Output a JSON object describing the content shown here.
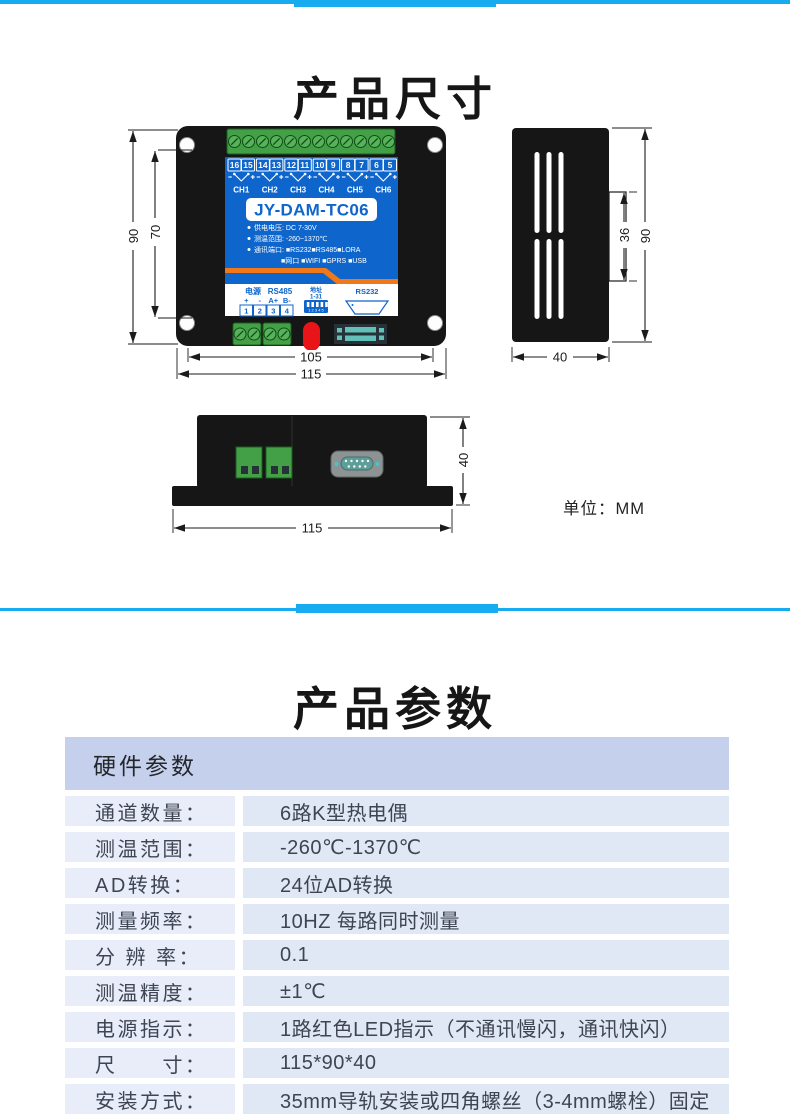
{
  "accent_color": "#17abf0",
  "sections": {
    "dimensions": {
      "title": "产品尺寸",
      "unit_note": "单位：MM"
    },
    "parameters": {
      "title": "产品参数"
    }
  },
  "front": {
    "model": "JY-DAM-TC06",
    "terminals": [
      "16",
      "15",
      "14",
      "13",
      "12",
      "11",
      "10",
      "9",
      "8",
      "7",
      "6",
      "5"
    ],
    "channels": [
      "CH1",
      "CH2",
      "CH3",
      "CH4",
      "CH5",
      "CH6"
    ],
    "specs": [
      "供电电压: DC 7-30V",
      "测温范围: -260~1370℃",
      "通讯端口: ■RS232■RS485■LORA",
      "■网口 ■WIFI ■GPRS ■USB"
    ],
    "power_label": "电源",
    "rs485_label": "RS485",
    "pins": [
      "+",
      "-",
      "A+",
      "B-"
    ],
    "pin_numbers": [
      "1",
      "2",
      "3",
      "4"
    ],
    "addr_label": "地址",
    "addr_range": "1-31",
    "dip_numbers": "1 2 3 4 5",
    "rs232_label": "RS232",
    "dim_outer_height": "90",
    "dim_inner_height": "70",
    "dim_inner_width": "105",
    "dim_outer_width": "115"
  },
  "side": {
    "dim_tab": "36",
    "dim_height": "90",
    "dim_depth": "40"
  },
  "bottom": {
    "dim_depth": "40",
    "dim_width": "115"
  },
  "table": {
    "header": "硬件参数",
    "rows": [
      {
        "label": "通道数量：",
        "value": "6路K型热电偶"
      },
      {
        "label": "测温范围：",
        "value": "-260℃-1370℃"
      },
      {
        "label": "AD转换：",
        "value": "24位AD转换"
      },
      {
        "label": "测量频率：",
        "value": "10HZ 每路同时测量"
      },
      {
        "label": "分 辨 率：",
        "value": "0.1"
      },
      {
        "label": "测温精度：",
        "value": "±1℃"
      },
      {
        "label": "电源指示：",
        "value": "1路红色LED指示（不通讯慢闪，通讯快闪）"
      },
      {
        "label": "尺　　寸：",
        "value": "115*90*40"
      },
      {
        "label": "安装方式：",
        "value": "35mm导轨安装或四角螺丝（3-4mm螺栓）固定"
      }
    ]
  }
}
